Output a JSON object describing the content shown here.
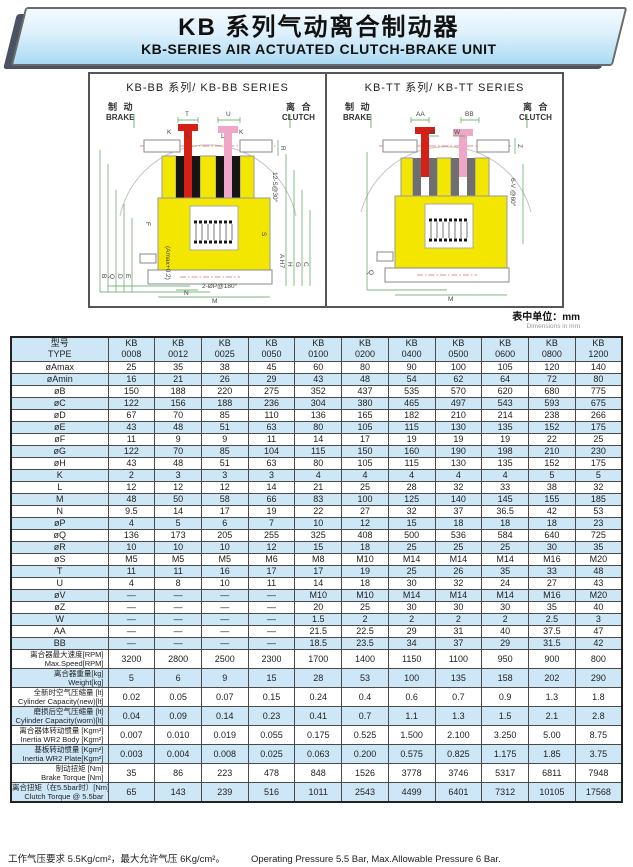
{
  "header": {
    "title_cn": "KB 系列气动离合制动器",
    "title_en": "KB-SERIES AIR ACTUATED CLUTCH-BRAKE UNIT"
  },
  "diagrams": {
    "left": {
      "title": "KB-BB 系列/ KB-BB SERIES",
      "brake_cn": "制 动",
      "brake_en": "BRAKE",
      "clutch_cn": "离 合",
      "clutch_en": "CLUTCH",
      "dims": [
        "T",
        "U",
        "K",
        "L",
        "L",
        "K",
        "R",
        "12-S@30°",
        "S",
        "F",
        "B",
        "Q",
        "D",
        "E",
        "(Amax+0.2)",
        "N",
        "M",
        "2-ØP@180°",
        "A H7",
        "H",
        "G",
        "C"
      ]
    },
    "right": {
      "title": "KB-TT 系列/ KB-TT SERIES",
      "brake_cn": "制 动",
      "brake_en": "BRAKE",
      "clutch_cn": "离 合",
      "clutch_en": "CLUTCH",
      "dims": [
        "AA",
        "W",
        "W",
        "BB",
        "Z",
        "6-V @60°",
        "Q",
        "M"
      ]
    },
    "colors": {
      "body_yellow": "#f3e600",
      "brake_red": "#d42015",
      "clutch_pink": "#f0a6c6",
      "dim_green": "#55a055",
      "pad_black": "#151515"
    }
  },
  "units_note": {
    "cn": "表中单位：mm",
    "en": "Dimensions in mm"
  },
  "table": {
    "header": {
      "label_cn": "型号",
      "label_en": "TYPE",
      "brand": "KB",
      "models": [
        "0008",
        "0012",
        "0025",
        "0050",
        "0100",
        "0200",
        "0400",
        "0500",
        "0600",
        "0800",
        "1200"
      ]
    },
    "rows": [
      {
        "l1": "øAmax",
        "values": [
          "25",
          "35",
          "38",
          "45",
          "60",
          "80",
          "90",
          "100",
          "105",
          "120",
          "140"
        ]
      },
      {
        "l1": "øAmin",
        "values": [
          "16",
          "21",
          "26",
          "29",
          "43",
          "48",
          "54",
          "62",
          "64",
          "72",
          "80"
        ]
      },
      {
        "l1": "øB",
        "values": [
          "150",
          "188",
          "220",
          "275",
          "352",
          "437",
          "535",
          "570",
          "620",
          "680",
          "775"
        ]
      },
      {
        "l1": "øC",
        "values": [
          "122",
          "156",
          "188",
          "236",
          "304",
          "380",
          "465",
          "497",
          "543",
          "593",
          "675"
        ]
      },
      {
        "l1": "øD",
        "values": [
          "67",
          "70",
          "85",
          "110",
          "136",
          "165",
          "182",
          "210",
          "214",
          "238",
          "266"
        ]
      },
      {
        "l1": "øE",
        "values": [
          "43",
          "48",
          "51",
          "63",
          "80",
          "105",
          "115",
          "130",
          "135",
          "152",
          "175"
        ]
      },
      {
        "l1": "øF",
        "values": [
          "11",
          "9",
          "9",
          "11",
          "14",
          "17",
          "19",
          "19",
          "19",
          "22",
          "25"
        ]
      },
      {
        "l1": "øG",
        "values": [
          "122",
          "70",
          "85",
          "104",
          "115",
          "150",
          "160",
          "190",
          "198",
          "210",
          "230"
        ]
      },
      {
        "l1": "øH",
        "values": [
          "43",
          "48",
          "51",
          "63",
          "80",
          "105",
          "115",
          "130",
          "135",
          "152",
          "175"
        ]
      },
      {
        "l1": "K",
        "values": [
          "2",
          "3",
          "3",
          "3",
          "4",
          "4",
          "4",
          "4",
          "4",
          "5",
          "5"
        ]
      },
      {
        "l1": "L",
        "values": [
          "12",
          "12",
          "12",
          "14",
          "21",
          "25",
          "28",
          "32",
          "33",
          "38",
          "32"
        ]
      },
      {
        "l1": "M",
        "values": [
          "48",
          "50",
          "58",
          "66",
          "83",
          "100",
          "125",
          "140",
          "145",
          "155",
          "185"
        ]
      },
      {
        "l1": "N",
        "values": [
          "9.5",
          "14",
          "17",
          "19",
          "22",
          "27",
          "32",
          "37",
          "36.5",
          "42",
          "53"
        ]
      },
      {
        "l1": "øP",
        "values": [
          "4",
          "5",
          "6",
          "7",
          "10",
          "12",
          "15",
          "18",
          "18",
          "18",
          "23"
        ]
      },
      {
        "l1": "øQ",
        "values": [
          "136",
          "173",
          "205",
          "255",
          "325",
          "408",
          "500",
          "536",
          "584",
          "640",
          "725"
        ]
      },
      {
        "l1": "øR",
        "values": [
          "10",
          "10",
          "10",
          "12",
          "15",
          "18",
          "25",
          "25",
          "25",
          "30",
          "35"
        ]
      },
      {
        "l1": "øS",
        "values": [
          "M5",
          "M5",
          "M5",
          "M6",
          "M8",
          "M10",
          "M14",
          "M14",
          "M14",
          "M16",
          "M20"
        ]
      },
      {
        "l1": "T",
        "values": [
          "11",
          "11",
          "16",
          "17",
          "17",
          "19",
          "25",
          "26",
          "35",
          "33",
          "48"
        ]
      },
      {
        "l1": "U",
        "values": [
          "4",
          "8",
          "10",
          "11",
          "14",
          "18",
          "30",
          "32",
          "24",
          "27",
          "43"
        ]
      },
      {
        "l1": "øV",
        "values": [
          "—",
          "—",
          "—",
          "—",
          "M10",
          "M10",
          "M14",
          "M14",
          "M14",
          "M16",
          "M20"
        ]
      },
      {
        "l1": "øZ",
        "values": [
          "—",
          "—",
          "—",
          "—",
          "20",
          "25",
          "30",
          "30",
          "30",
          "35",
          "40"
        ]
      },
      {
        "l1": "W",
        "values": [
          "—",
          "—",
          "—",
          "—",
          "1.5",
          "2",
          "2",
          "2",
          "2",
          "2.5",
          "3"
        ]
      },
      {
        "l1": "AA",
        "values": [
          "—",
          "—",
          "—",
          "—",
          "21.5",
          "22.5",
          "29",
          "31",
          "40",
          "37.5",
          "47"
        ]
      },
      {
        "l1": "BB",
        "values": [
          "—",
          "—",
          "—",
          "—",
          "18.5",
          "23.5",
          "34",
          "37",
          "29",
          "31.5",
          "42"
        ]
      },
      {
        "l1": "离合器最大速度[RPM]",
        "l2": "Max.Speed[RPM]",
        "values": [
          "3200",
          "2800",
          "2500",
          "2300",
          "1700",
          "1400",
          "1150",
          "1100",
          "950",
          "900",
          "800"
        ]
      },
      {
        "l1": "离合器重量[kg]",
        "l2": "Weight[kg]",
        "values": [
          "5",
          "6",
          "9",
          "15",
          "28",
          "53",
          "100",
          "135",
          "158",
          "202",
          "290"
        ]
      },
      {
        "l1": "全新时空气压缩量 [lt]",
        "l2": "Cylinder Capacity(new)[lt]",
        "values": [
          "0.02",
          "0.05",
          "0.07",
          "0.15",
          "0.24",
          "0.4",
          "0.6",
          "0.7",
          "0.9",
          "1.3",
          "1.8"
        ]
      },
      {
        "l1": "磨损后空气压缩量 [lt]",
        "l2": "Cylinder Capacity(worn)[lt]",
        "values": [
          "0.04",
          "0.09",
          "0.14",
          "0.23",
          "0.41",
          "0.7",
          "1.1",
          "1.3",
          "1.5",
          "2.1",
          "2.8"
        ]
      },
      {
        "l1": "离合器体转动惯量 [Kgm²]",
        "l2": "Inertia WR2 Body [Kgm²]",
        "values": [
          "0.007",
          "0.010",
          "0.019",
          "0.055",
          "0.175",
          "0.525",
          "1.500",
          "2.100",
          "3.250",
          "5.00",
          "8.75"
        ]
      },
      {
        "l1": "基板转动惯量 [Kgm²]",
        "l2": "Inertia WR2 Plate[Kgm²]",
        "values": [
          "0.003",
          "0.004",
          "0.008",
          "0.025",
          "0.063",
          "0.200",
          "0.575",
          "0.825",
          "1.175",
          "1.85",
          "3.75"
        ]
      },
      {
        "l1": "制动扭矩 [Nm]",
        "l2": "Brake Torque [Nm]",
        "values": [
          "35",
          "86",
          "223",
          "478",
          "848",
          "1526",
          "3778",
          "3746",
          "5317",
          "6811",
          "7948"
        ]
      },
      {
        "l1": "离合扭矩（在5.5bar时）[Nm]",
        "l2": "Clutch Torque @ 5.5bar",
        "values": [
          "65",
          "143",
          "239",
          "516",
          "1011",
          "2543",
          "4499",
          "6401",
          "7312",
          "10105",
          "17568"
        ]
      }
    ]
  },
  "footer": {
    "cn": "工作气压要求 5.5Kg/cm²，最大允许气压 6Kg/cm²。",
    "en": "Operating Pressure 5.5 Bar, Max.Allowable Pressure 6 Bar."
  }
}
